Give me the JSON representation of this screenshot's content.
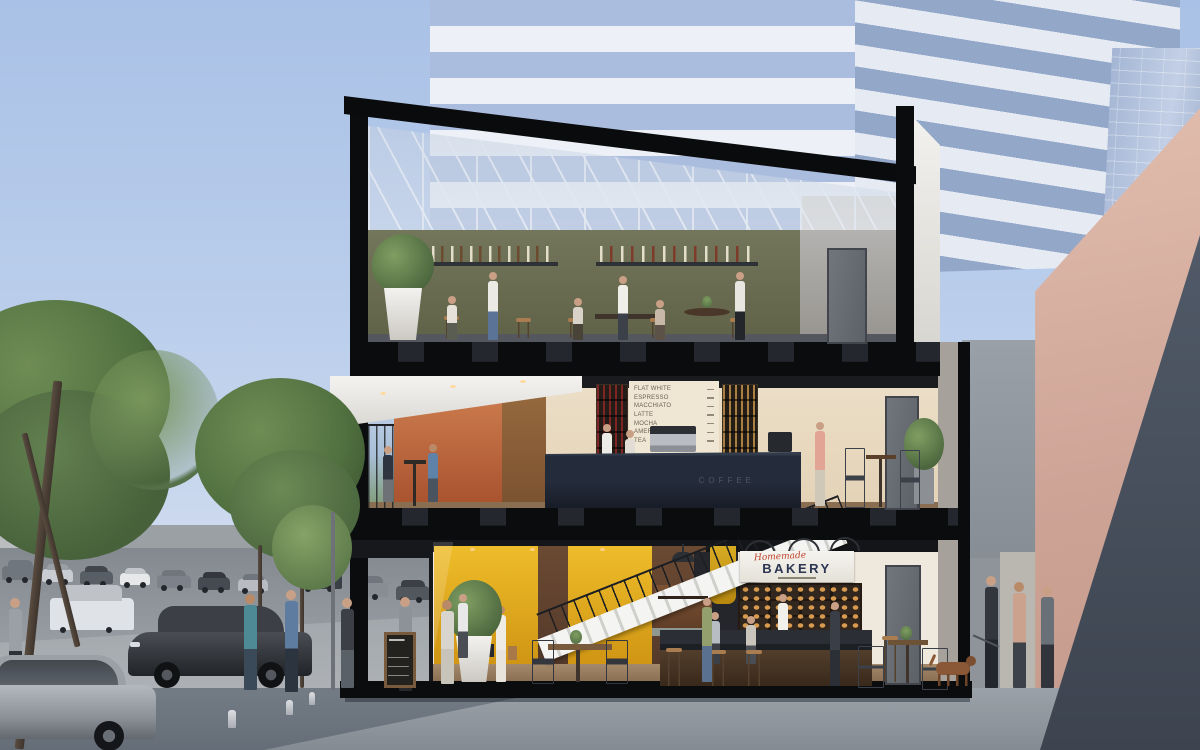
{
  "scene_title": "Three-storey mixed-use building cross-section with rooftop bar, coffee bar and street-level bakery",
  "signs": {
    "bakery_script": "Homemade",
    "bakery_main": "BAKERY",
    "coffee_counter": "COFFEE"
  },
  "menu_board": {
    "items": [
      "FLAT WHITE",
      "ESPRESSO",
      "MACCHIATO",
      "LATTE",
      "MOCHA",
      "AMERICANO",
      "TEA"
    ]
  },
  "palette": {
    "sky": "#b3c8ea",
    "section_black": "#0b0c0e",
    "bakery_yellow": "#e3a91c",
    "terrace_terracotta": "#bf6a42",
    "olive_wall": "#6e7254",
    "counter_navy": "#232a36",
    "sign_red": "#c0432e",
    "sign_navy": "#2c3552",
    "pink_building": "#d6ac9f",
    "tower_glass": "#a9bcdc"
  }
}
